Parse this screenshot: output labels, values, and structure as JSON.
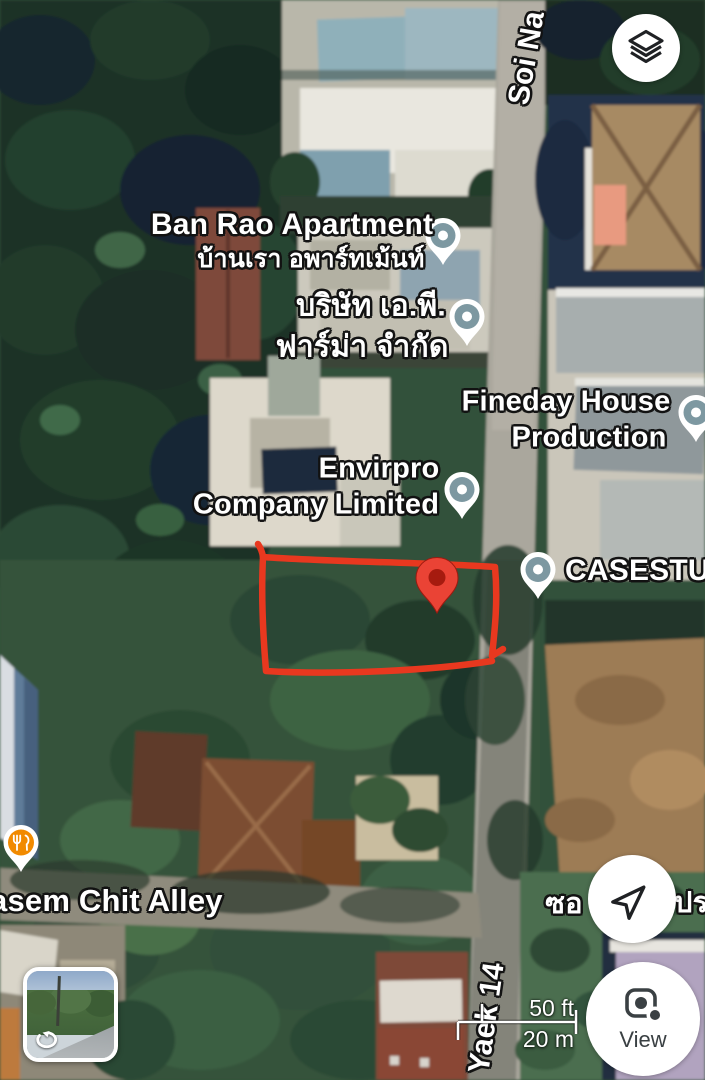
{
  "places": {
    "ban_rao_apartment": {
      "name": "Ban Rao Apartment",
      "thai_name": "บ้านเรา อพาร์ทเม้นท์"
    },
    "ap_pharma": {
      "thai_name_line1": "บริษัท เอ.พี.",
      "thai_name_line2": "ฟาร์ม่า จำกัด"
    },
    "fineday_house": {
      "name_line1": "Fineday House",
      "name_line2": "Production"
    },
    "envirpro": {
      "name_line1": "Envirpro",
      "name_line2": "Company Limited"
    },
    "casestudy": {
      "name_partial": "CASESTUD"
    }
  },
  "streets": {
    "soi_na_partial": "Soi Na",
    "kasem_chit_alley_partial": "asem Chit Alley",
    "yaek_14": "Yaek 14",
    "thai_street_fragment_left": "ซอ",
    "thai_street_fragment_right": "ปร"
  },
  "controls": {
    "view_button_label": "View"
  },
  "scale_bar": {
    "imperial": "50 ft",
    "metric": "20 m"
  },
  "icons": {
    "layers": "stacked-layers",
    "my_location": "navigation-arrow",
    "view_camera": "lens-camera",
    "street_view_rotate": "circular-arrow-360",
    "restaurant_pin": "fork-and-knife",
    "place_pin": "teardrop-map-pin",
    "selected_pin": "red-map-pin"
  },
  "colors": {
    "place_pin": "#7d98a1",
    "restaurant_pin": "#f18a00",
    "selected_pin": "#ea4335",
    "selected_pin_inner": "#a61b0f",
    "annotation": "#e8381f",
    "label_text": "#ffffff",
    "control_icon": "#1f2124"
  }
}
